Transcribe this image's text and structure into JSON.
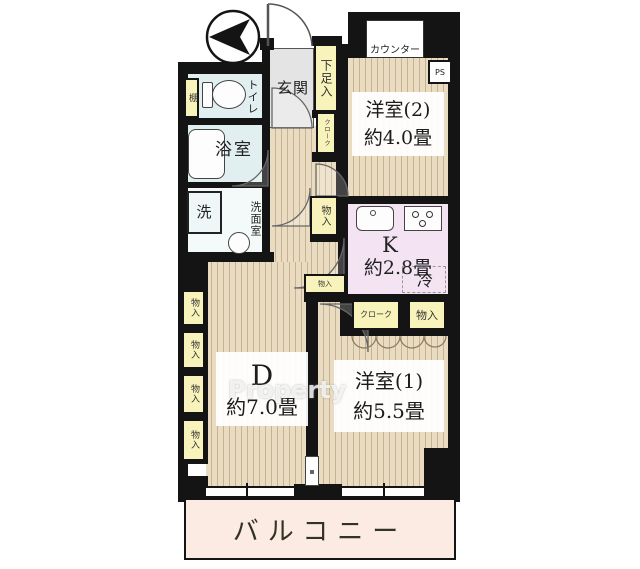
{
  "plan_title": "apartment-floor-plan",
  "labels": {
    "entrance": "玄関",
    "shoe_cabinet": "下足入",
    "toilet": "トイレ",
    "shelf": "棚",
    "bathroom": "浴室",
    "washer": "洗",
    "washroom": "洗面室",
    "counter": "カウンター",
    "pipe_space": "PS",
    "closet": "物入",
    "cloak": "クローク",
    "fridge": "冷",
    "balcony": "バルコニー"
  },
  "rooms": {
    "western2": {
      "name": "洋室(2)",
      "area": "約4.0畳"
    },
    "kitchen": {
      "name": "K",
      "area": "約2.8畳"
    },
    "dining": {
      "name": "D",
      "area": "約7.0畳"
    },
    "western1": {
      "name": "洋室(1)",
      "area": "約5.5畳"
    }
  },
  "watermark": "Property",
  "colors": {
    "wall": "#141414",
    "wood_floor": "#e9dcc2",
    "wood_stripe": "#c8b28c",
    "wet_area": "#e2eff1",
    "closet": "#f8f3bb",
    "kitchen": "#f3e3f3",
    "entrance_floor": "#e4e4e4",
    "balcony": "#fcebe2"
  }
}
